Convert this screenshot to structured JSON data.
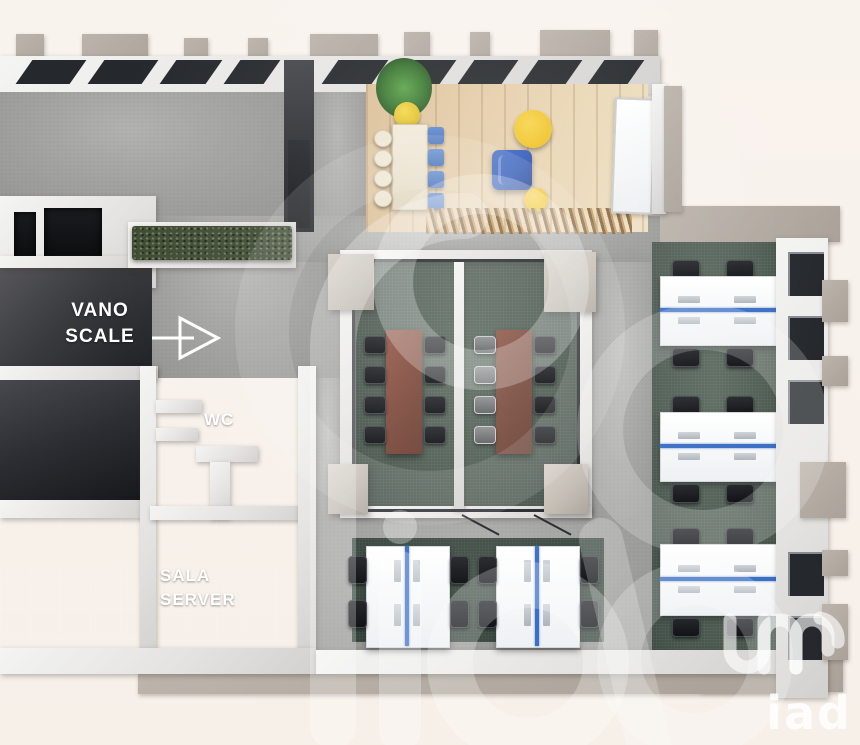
{
  "scene": {
    "type": "3d-floor-plan-render",
    "description": "Top-down 3D render of an office floor plan with lounge, two glass meeting rooms, open-space workstations, WC, server room and stairwell",
    "background": "#f8f1eb"
  },
  "labels": {
    "vano_scale": {
      "line1": "VANO",
      "line2": "SCALE"
    },
    "wc": "WC",
    "sala_server": {
      "line1": "SALA",
      "line2": "SERVER"
    }
  },
  "brand": {
    "watermark_text": "iad",
    "logo_text": "iad"
  },
  "palette": {
    "background": "#f8f1eb",
    "corridor_floor": "#a2a2a0",
    "wood_floor": "#e2c8a2",
    "meeting_carpet": "#4e5c52",
    "openspace_carpet": "#41504 8",
    "dark_room_floor": "#2b2d31",
    "wall_white": "#efefef",
    "wall_tan": "#b2aaa1",
    "desk_accent_blue": "#3a6fc4",
    "armchair_blue": "#2b55b5",
    "pouf_yellow": "#f1c220",
    "meeting_table_brown": "#8a5141",
    "chair_black": "#17181a",
    "hedge_green": "#3f4a35",
    "plant_green": "#3f7d35"
  },
  "furniture_inventory": {
    "meeting_rooms": 2,
    "meeting_tables": 2,
    "meeting_chairs": 16,
    "workstation_clusters_right": 3,
    "workstation_clusters_bottom": 2,
    "workstation_chairs": 20,
    "lounge_table_chairs": 8,
    "yellow_poufs": 2,
    "blue_armchair": 1,
    "slat_bench": 1,
    "whiteboard": 1,
    "potted_plant": 1,
    "hedge_planter": 1,
    "wc_stalls": 2,
    "entrance_arrow": 1
  }
}
